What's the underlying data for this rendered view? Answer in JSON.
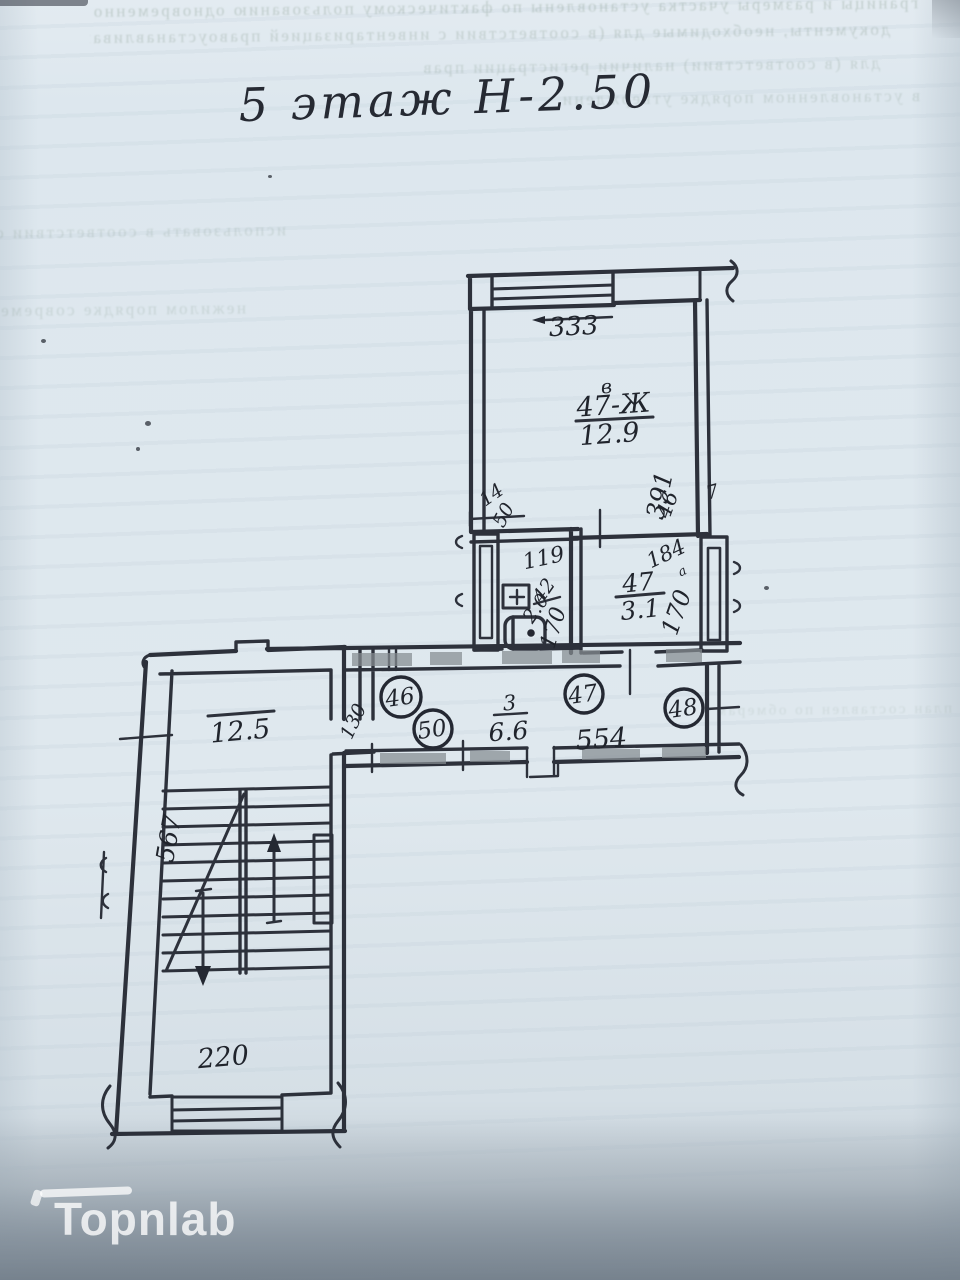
{
  "page": {
    "title": "5 этаж Н-2.50",
    "watermark": "Topnlab"
  },
  "plan": {
    "living_room": {
      "tag": "в",
      "number": "47-Ж",
      "area": "12.9",
      "window_width": "333",
      "depth": "391"
    },
    "bathroom": {
      "number": "42",
      "area": "2.0",
      "width": "119",
      "depth": "170",
      "dim_jamb": "14",
      "dim_pier": "50"
    },
    "room_47a": {
      "number": "47",
      "superscript": "а",
      "area": "3.1",
      "width": "184",
      "depth": "170",
      "dim_jamb": "46",
      "dim_pier": "7"
    },
    "hallway": {
      "number": "3",
      "area": "6.6",
      "length": "554",
      "opening": "130"
    },
    "stairwell": {
      "landing_area": "12.5",
      "depth": "567",
      "width": "220"
    },
    "apartment_numbers": [
      "46",
      "50",
      "47",
      "48"
    ]
  },
  "bleed_text": {
    "lines": [
      "границы и размеры участка установлены по фактическому пользованию одновременно",
      "документы, необходимые для (в соответствии с инвентаризацией правоустанавливающих",
      "для (в соответствии) наличии регистрации прав",
      "в установленном порядке утверждении'я",
      "использовать в соответствии с планом",
      "нежилом порядке современном утверждении",
      "план составлен по обмерам в натуре"
    ]
  }
}
